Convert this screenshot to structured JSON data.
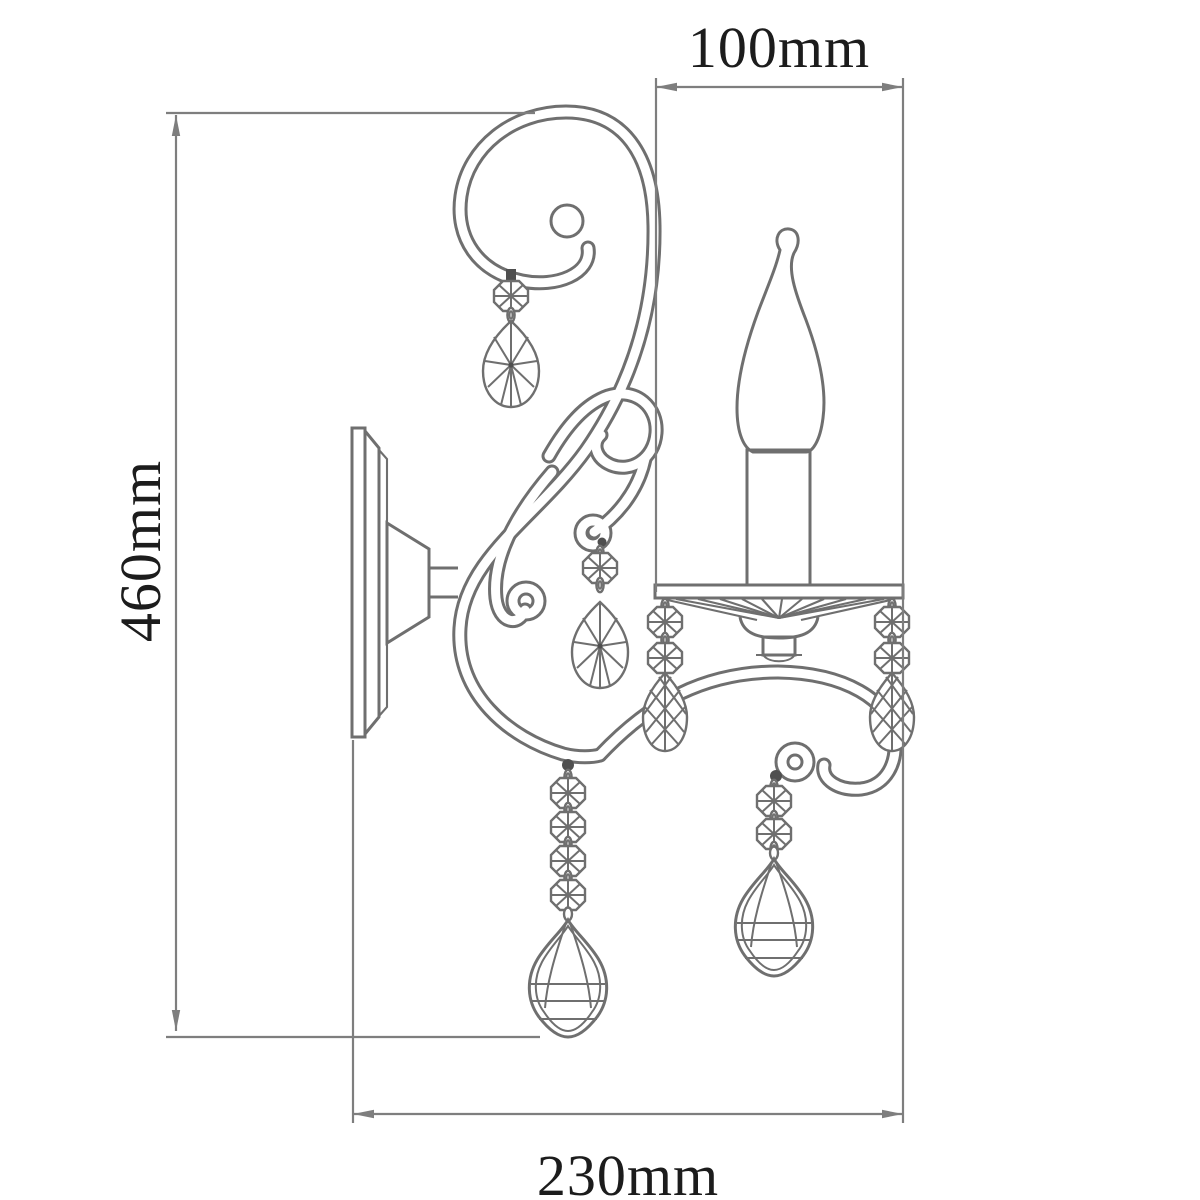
{
  "drawing": {
    "subject": "crystal wall sconce line drawing",
    "view": "side elevation with dimensions"
  },
  "dimensions": {
    "top_width": {
      "label": "100mm"
    },
    "height": {
      "label": "460mm"
    },
    "depth": {
      "label": "230mm"
    }
  },
  "colors": {
    "background": "#ffffff",
    "line_art": "#6f6f6f",
    "dimension_lines": "#7e7e7e",
    "label_text": "#1c1c1c"
  }
}
